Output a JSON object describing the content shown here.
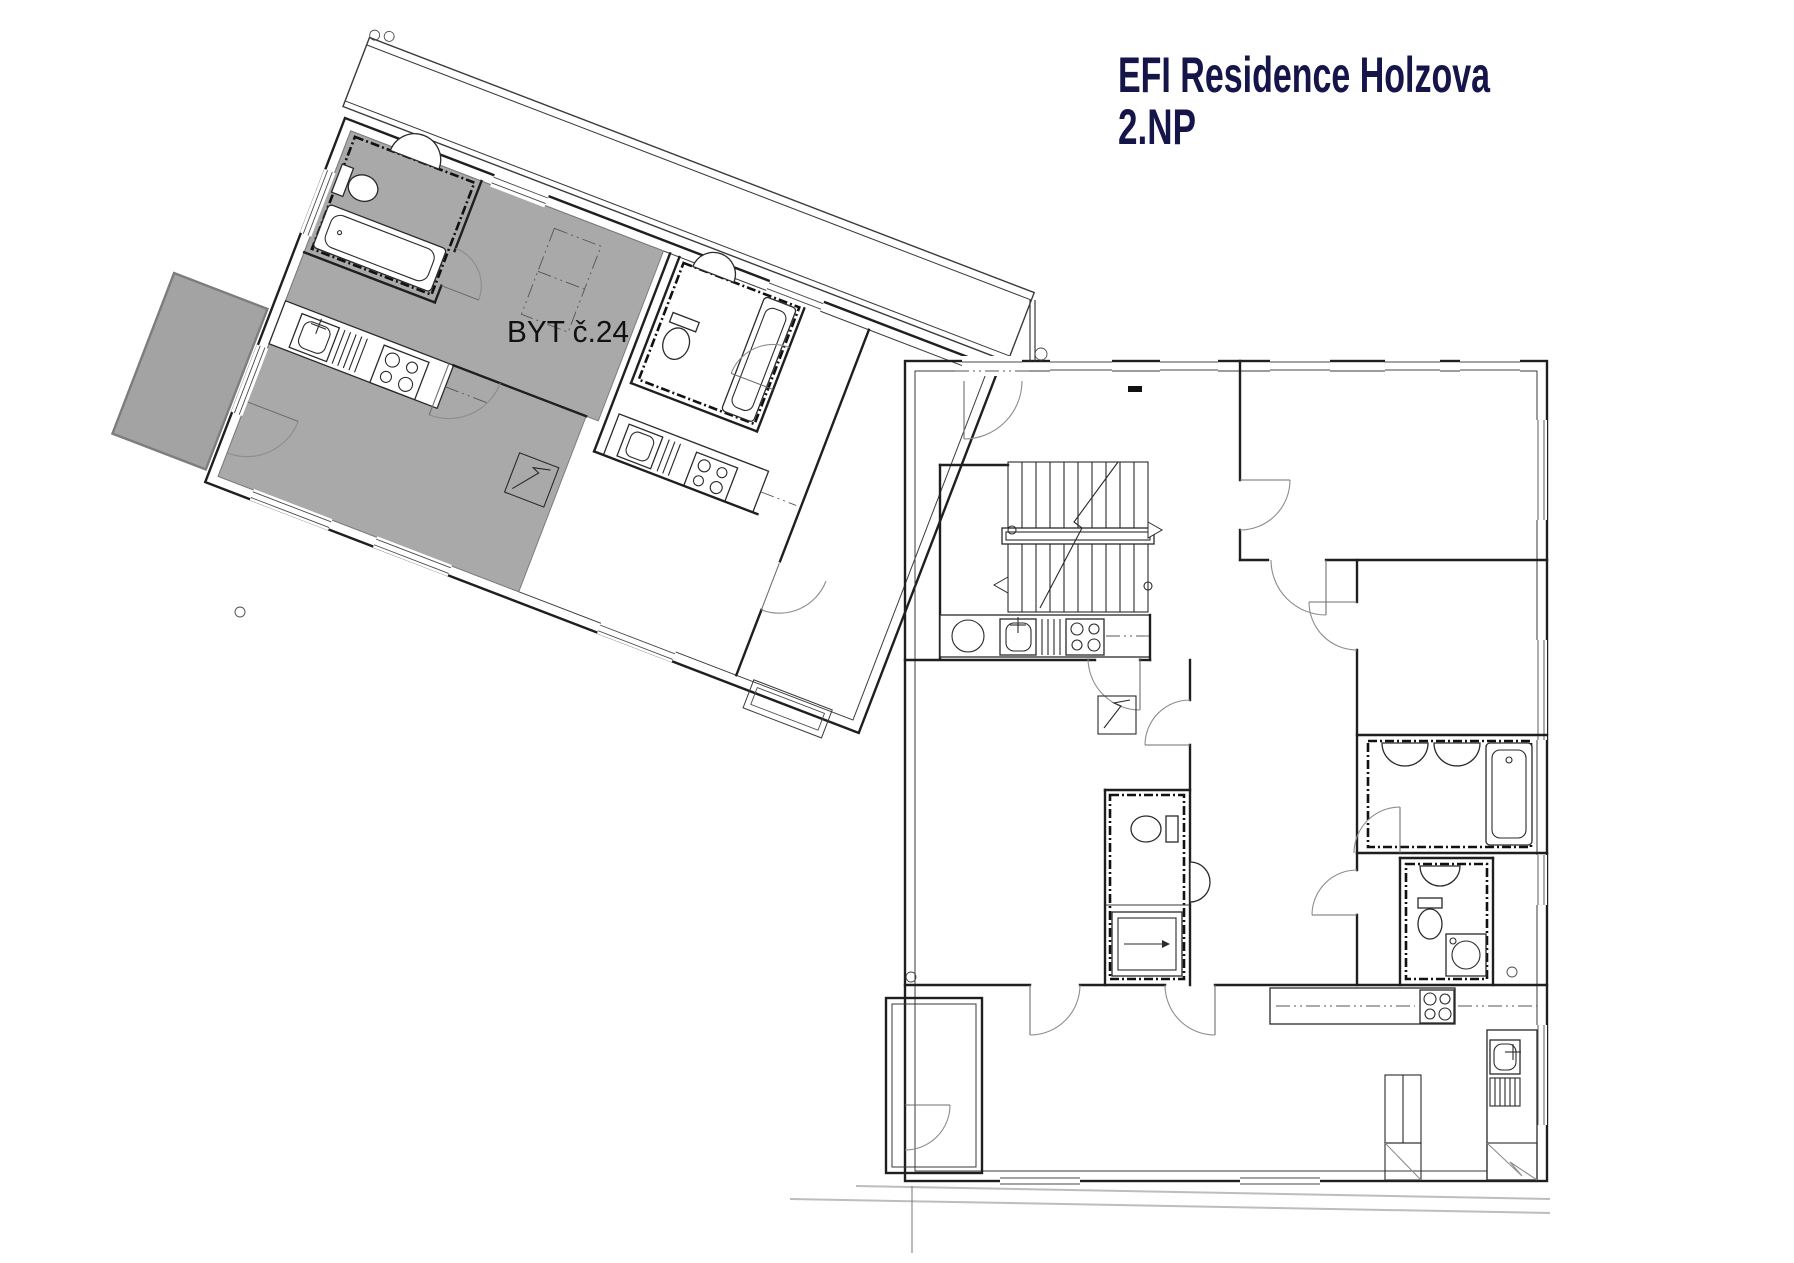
{
  "title": {
    "line1": "EFI Residence Holzova",
    "line2": "2.NP"
  },
  "plan": {
    "highlighted_unit_label": "BYT č.24",
    "floor_shown": "2.NP",
    "building_name": "EFI Residence Holzova"
  },
  "colors": {
    "title_text": "#15154a",
    "highlighted_unit_fill": "#a9a9a9",
    "balcony_fill": "#a3a3a3",
    "wall_line": "#1f1f1f",
    "terrain_line": "#bdbdbd",
    "background": "#ffffff"
  }
}
